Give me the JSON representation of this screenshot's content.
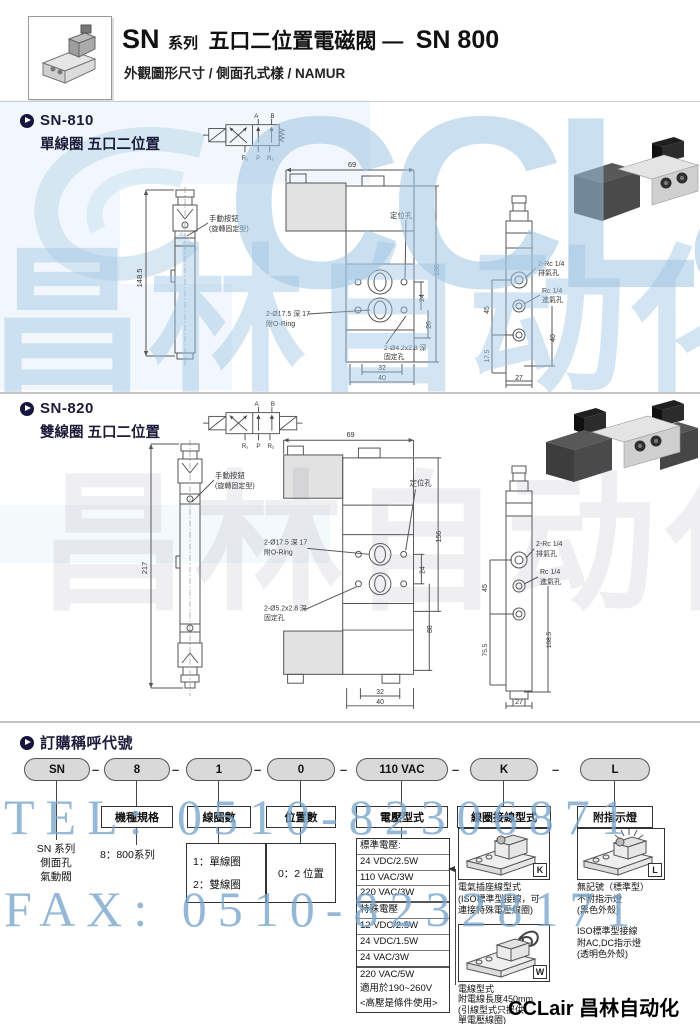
{
  "header": {
    "sn": "SN",
    "series": "系列",
    "title": "五口二位置電磁閥 —",
    "model": "SN 800",
    "subtitle": "外觀圖形尺寸 / 側面孔式樣 / NAMUR"
  },
  "watermark": {
    "brand": "CCLair",
    "brand_cn": "昌林自动化",
    "tel": "TEL: 0510-82306871",
    "fax": "FAX: 0510-82328171",
    "footer": "CCLair 昌林自动化"
  },
  "sn810": {
    "model": "SN-810",
    "desc": "單線圈 五口二位置",
    "sym": {
      "a": "A",
      "b": "B",
      "r1": "R₁",
      "p": "P",
      "r2": "R₂"
    },
    "front": {
      "height": "148.5",
      "manual1": "手動按鈕",
      "manual2": "(旋轉固定型)"
    },
    "mid": {
      "width": "69",
      "height": "136",
      "s1": "24",
      "s2": "26",
      "b1": "32",
      "b2": "40",
      "locating": "定位孔",
      "oring1": "2-Ø17.5 深 17",
      "oring2": "附O-Ring",
      "fix1": "2-Ø4.2x2.8 深",
      "fix2": "固定孔"
    },
    "side": {
      "d45": "45",
      "d175": "17.5",
      "d27": "27",
      "d40": "40",
      "ex1": "2-Rc 1/4",
      "ex2": "排氣孔",
      "in1": "Rc 1/4",
      "in2": "進氣孔"
    }
  },
  "sn820": {
    "model": "SN-820",
    "desc": "雙線圈 五口二位置",
    "sym": {
      "a": "A",
      "b": "B",
      "r1": "R₁",
      "p": "P",
      "r2": "R₂"
    },
    "front": {
      "height": "217",
      "manual1": "手動按鈕",
      "manual2": "(旋轉固定型)"
    },
    "mid": {
      "width": "69",
      "height": "156",
      "s1": "24",
      "s2": "88",
      "b1": "32",
      "b2": "40",
      "locating": "定位孔",
      "oring1": "2-Ø17.5 深 17",
      "oring2": "附O-Ring",
      "fix1": "2-Ø5.2x2.8 深",
      "fix2": "固定孔"
    },
    "side": {
      "d45": "45",
      "d755": "75.5",
      "d27": "27",
      "d1085": "108.5",
      "ex1": "2-Rc 1/4",
      "ex2": "排氣孔",
      "in1": "Rc 1/4",
      "in2": "進氣孔"
    }
  },
  "ordering": {
    "heading": "訂購稱呼代號",
    "dash": "–",
    "pills": [
      "SN",
      "8",
      "1",
      "0",
      "110 VAC",
      "K",
      "L"
    ],
    "headers": [
      "機種規格",
      "線圈數",
      "位置數",
      "電壓型式",
      "線圈接線型式",
      "附指示燈"
    ],
    "sn_note": [
      "SN 系列",
      "側面孔",
      "氣動閥"
    ],
    "spec_note": "8：800系列",
    "coil_opts": [
      "1：單線圈",
      "2：雙線圈"
    ],
    "pos_opt": "0：2 位置",
    "voltage": [
      "標準電壓:",
      "24 VDC/2.5W",
      "110 VAC/3W",
      "220 VAC/3W",
      "特殊電壓",
      "12 VDC/2.5W",
      "24 VDC/1.5W",
      "24 VAC/3W",
      "220 VAC/5W",
      "適用於190~260V",
      "<高壓是條件使用>"
    ],
    "k_tag": "K",
    "k_cap": [
      "電氣插座線型式",
      "(ISO標準型接線，可",
      "連接特殊電壓線圈)"
    ],
    "w_tag": "W",
    "w_cap": [
      "電線型式",
      "附電線長度450mm",
      "(引線型式只提供",
      "單電壓線圈)"
    ],
    "l_tag": "L",
    "l_cap1": [
      "無記號（標準型）",
      "不附指示燈",
      "(黑色外殼)"
    ],
    "l_cap2": [
      "ISO標準型接線",
      "附AC,DC指示燈",
      "(透明色外殼)"
    ]
  }
}
